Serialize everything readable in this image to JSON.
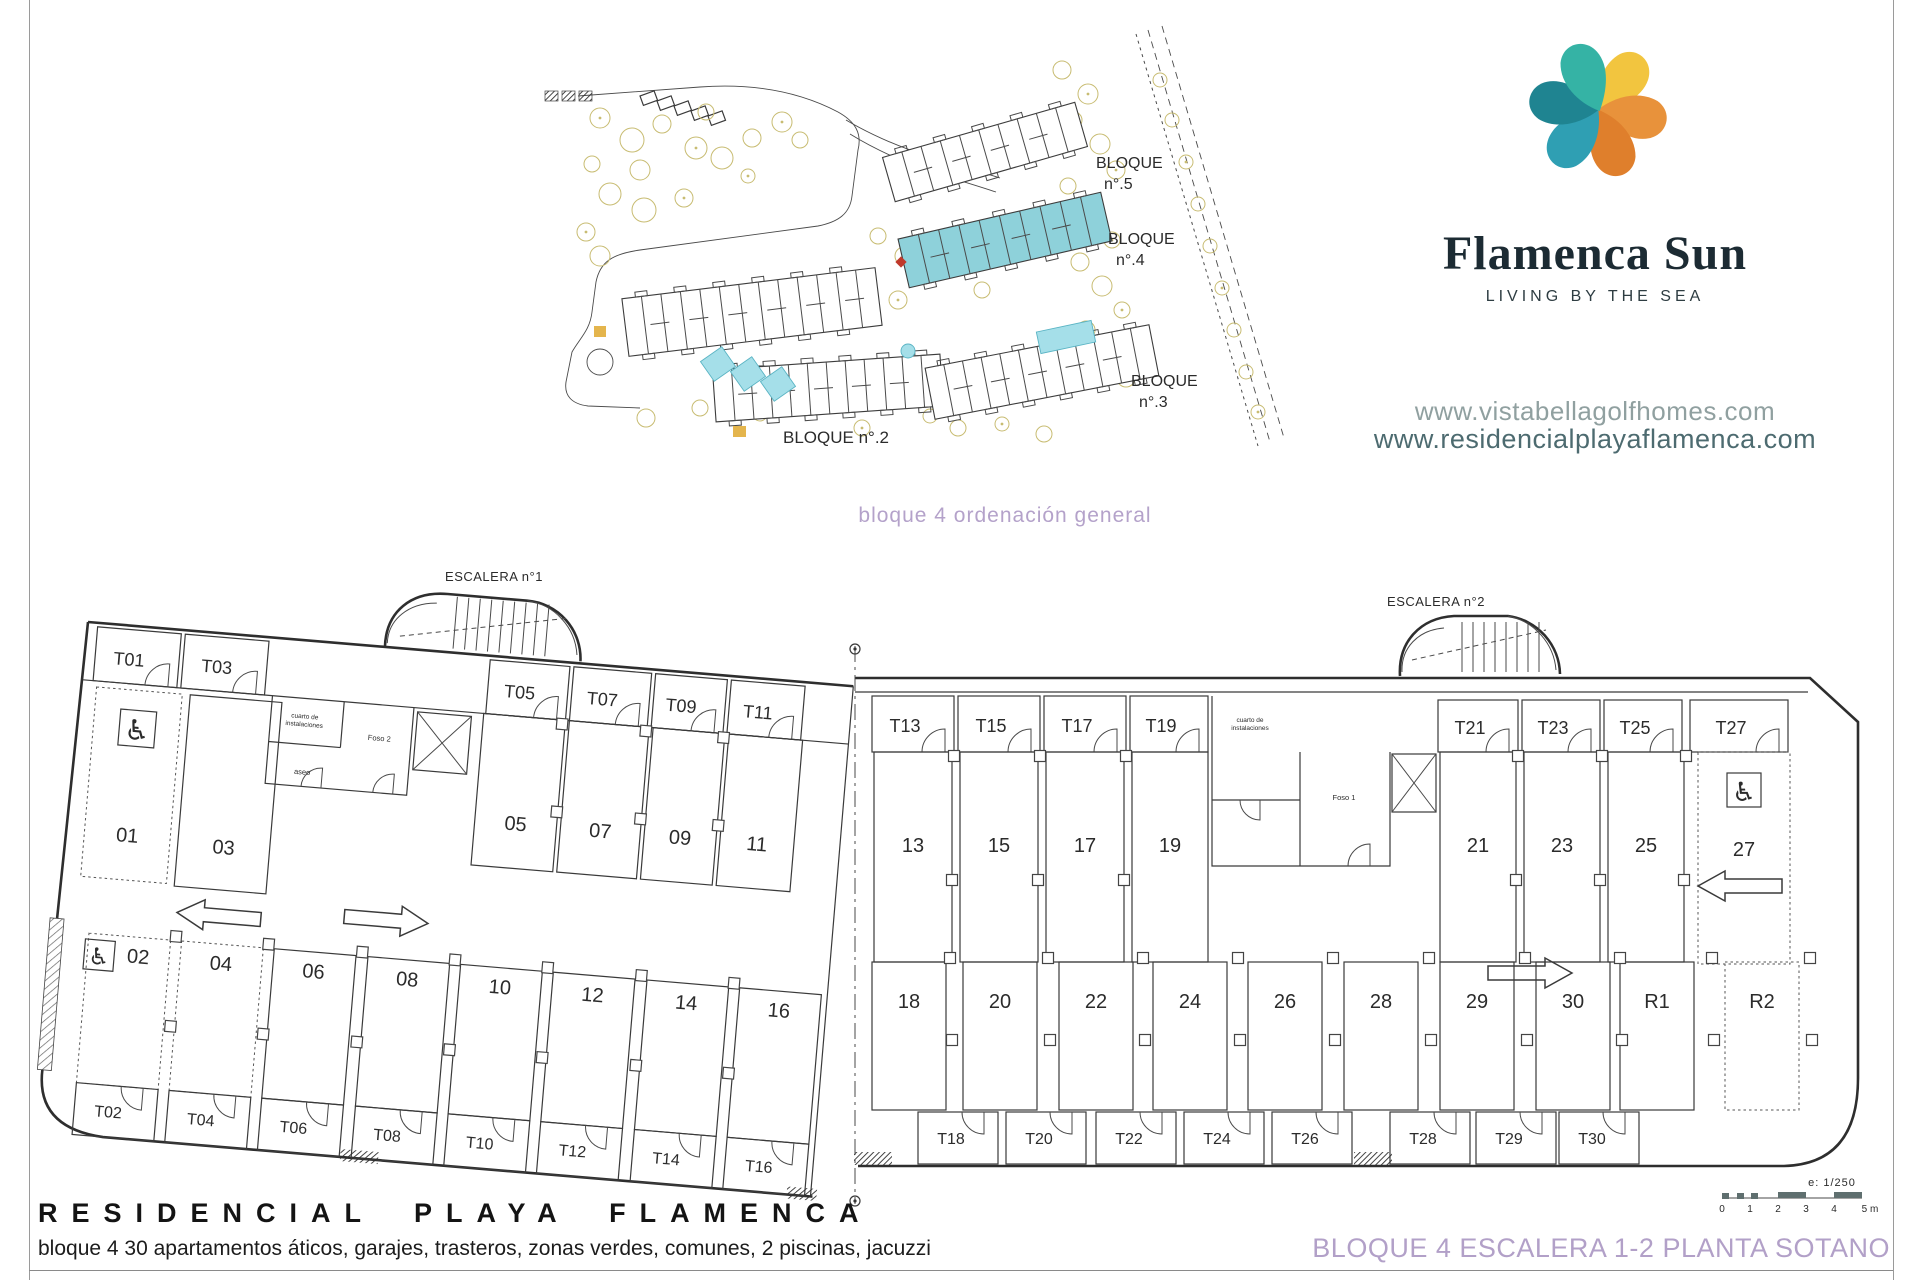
{
  "site_plan": {
    "caption": "bloque 4 ordenación general",
    "blocks": [
      "BLOQUE n°.1",
      "BLOQUE n°.2",
      "BLOQUE n°.3",
      "BLOQUE n°.4",
      "BLOQUE n°.5"
    ]
  },
  "branding": {
    "name": "Flamenca Sun",
    "tagline": "LIVING BY THE SEA",
    "website_1": "www.vistabellagolfhomes.com",
    "website_2": "www.residencialplayaflamenca.com"
  },
  "floor_plan": {
    "stair_labels": [
      "ESCALERA n°1",
      "ESCALERA n°2"
    ],
    "parking_left_top": [
      "01",
      "03",
      "05",
      "07",
      "09",
      "11"
    ],
    "parking_left_bottom": [
      "02",
      "04",
      "06",
      "08",
      "10",
      "12",
      "14",
      "16"
    ],
    "parking_mid_top": [
      "13",
      "15",
      "17",
      "19"
    ],
    "parking_right_top": [
      "21",
      "23",
      "25",
      "27"
    ],
    "parking_right_bottom": [
      "18",
      "20",
      "22",
      "24",
      "26",
      "28",
      "29",
      "30",
      "R1",
      "R2"
    ],
    "storage_left_top": [
      "T01",
      "T03",
      "T05",
      "T07",
      "T09",
      "T11"
    ],
    "storage_left_bottom": [
      "T02",
      "T04",
      "T06",
      "T08",
      "T10",
      "T12",
      "T14",
      "T16"
    ],
    "storage_mid_top": [
      "T13",
      "T15",
      "T17",
      "T19"
    ],
    "storage_right_top": [
      "T21",
      "T23",
      "T25",
      "T27"
    ],
    "storage_right_bottom": [
      "T18",
      "T20",
      "T22",
      "T24",
      "T26",
      "T28",
      "T29",
      "T30"
    ],
    "utility_notes": [
      "cuarto de instalaciones",
      "Foso 2",
      "aseo",
      "Foso 1"
    ]
  },
  "title_block": {
    "project": "RESIDENCIAL PLAYA FLAMENCA",
    "description": "bloque 4 30 apartamentos áticos, garajes, trasteros, zonas verdes, comunes, 2 piscinas, jacuzzi",
    "drawing_title": "BLOQUE 4 ESCALERA 1-2 PLANTA SOTANO",
    "scale_label": "e: 1/250",
    "scale_ticks": [
      "0",
      "1",
      "2",
      "3",
      "4",
      "5 m"
    ]
  },
  "colors": {
    "accent_purple": "#b3a1c9",
    "block_highlight": "#8ed1da",
    "logo_orange": "#e8923b",
    "logo_yellow": "#f2c53f",
    "logo_teal": "#35b3a5",
    "logo_dark_teal": "#1f8491"
  }
}
